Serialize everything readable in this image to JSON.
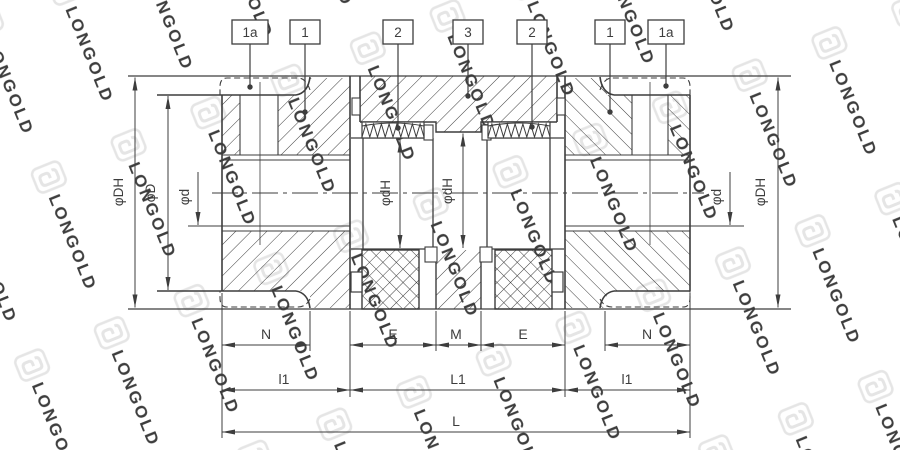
{
  "watermark": {
    "brand_text": "LONGOLD"
  },
  "callouts": [
    {
      "label": "1a"
    },
    {
      "label": "1"
    },
    {
      "label": "2"
    },
    {
      "label": "3"
    },
    {
      "label": "2"
    },
    {
      "label": "1"
    },
    {
      "label": "1a"
    }
  ],
  "dimensions": {
    "phi_DH_left": "φDH",
    "phi_D_left": "φD",
    "phi_d_left": "φd",
    "phi_dH_left": "φdH",
    "phi_dH_center": "φdH",
    "phi_d_right": "φd",
    "phi_DH_right": "φDH",
    "N_left": "N",
    "E_left": "E",
    "M_center": "M",
    "E_right": "E",
    "N_right": "N",
    "l1_left": "l1",
    "L1_center": "L1",
    "l1_right": "l1",
    "L_total": "L"
  },
  "colors": {
    "line": "#3d3d3d",
    "watermark": "#e5e5e5",
    "background": "#ffffff"
  }
}
